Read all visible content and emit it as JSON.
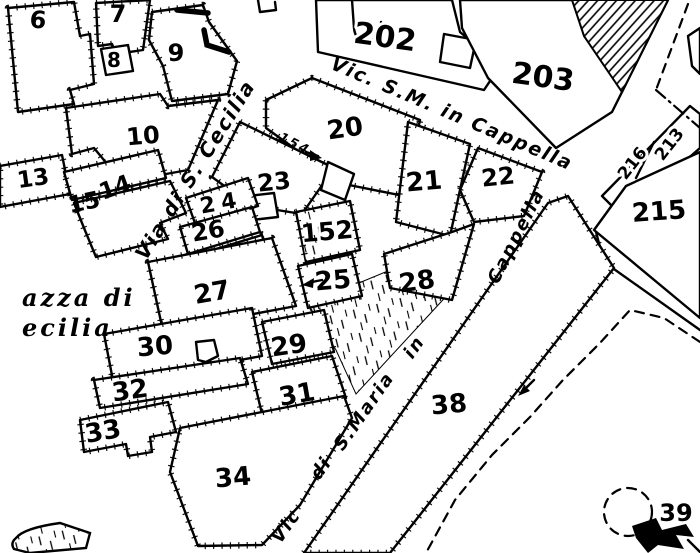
{
  "colors": {
    "paper": "#ffffff",
    "ink": "#000000"
  },
  "parcels": {
    "p6": "6",
    "p7": "7",
    "p8": "8",
    "p9": "9",
    "p10": "10",
    "p13": "13",
    "p14": "14",
    "p15": "15",
    "p20": "20",
    "p21": "21",
    "p22": "22",
    "p23": "23",
    "p24": "24",
    "p25": "25",
    "p26": "26",
    "p27": "27",
    "p28": "28",
    "p29": "29",
    "p30": "30",
    "p31": "31",
    "p32": "32",
    "p33": "33",
    "p34": "34",
    "p38": "38",
    "p39": "39",
    "p152": "152",
    "p202": "202",
    "p203": "203",
    "p213": "213",
    "p215": "215",
    "p216": "216"
  },
  "streets": {
    "via_di_s_cecilia": "Via di S. Cecilia",
    "vic_sm_in_cappella": "Vic. S.M. in Cappella",
    "cappella": "Cappella",
    "in_word": "in",
    "s_maria": "S.Maria",
    "di_word": "di",
    "vic_word": "Vic"
  },
  "place": {
    "piazza_line1": "azza di",
    "piazza_line2": "ecilia"
  },
  "annotation": {
    "house_number": "154"
  }
}
